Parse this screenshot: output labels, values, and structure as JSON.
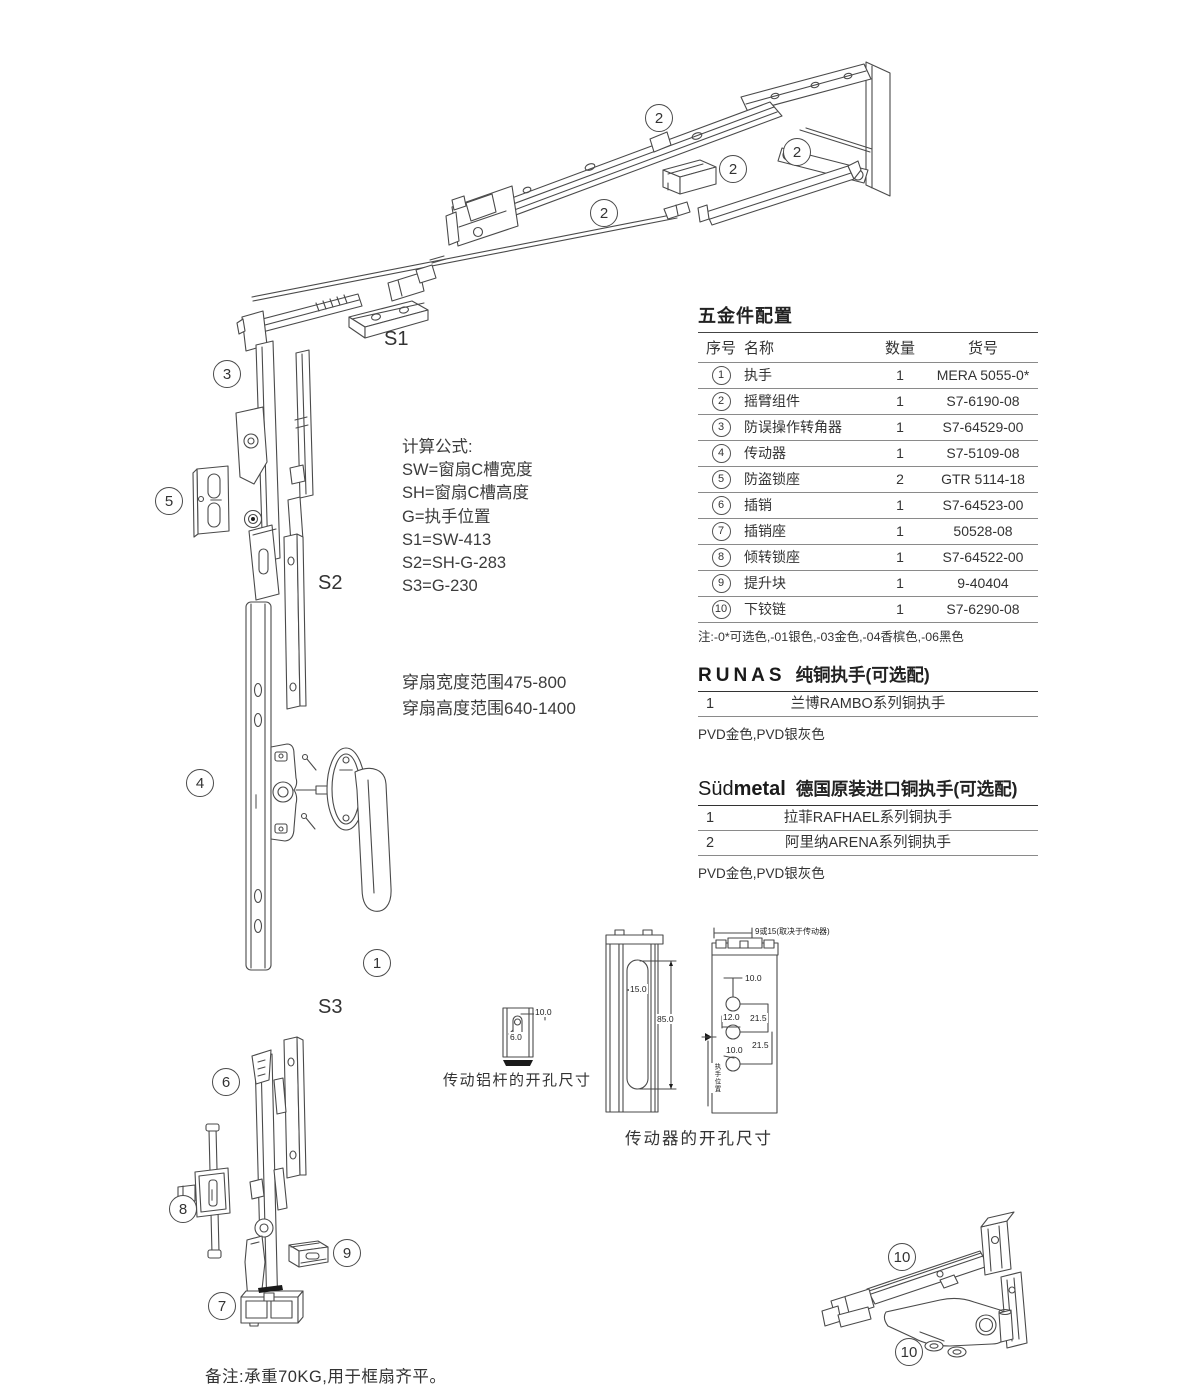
{
  "diagram": {
    "callouts": [
      "2",
      "2",
      "2",
      "2",
      "3",
      "5",
      "4",
      "1",
      "6",
      "8",
      "9",
      "7",
      "10",
      "10"
    ],
    "s_labels": {
      "s1": "S1",
      "s2": "S2",
      "s3": "S3"
    }
  },
  "formulas": {
    "heading": "计算公式:",
    "lines": [
      "SW=窗扇C槽宽度",
      "SH=窗扇C槽高度",
      "G=执手位置",
      "S1=SW-413",
      "S2=SH-G-283",
      "S3=G-230"
    ]
  },
  "sash_range": {
    "lines": [
      "穿扇宽度范围475-800",
      "穿扇高度范围640-1400"
    ]
  },
  "hardware_table": {
    "title": "五金件配置",
    "headers": {
      "no": "序号",
      "name": "名称",
      "qty": "数量",
      "sku": "货号"
    },
    "rows": [
      {
        "no": "1",
        "name": "执手",
        "qty": "1",
        "sku": "MERA 5055-0*"
      },
      {
        "no": "2",
        "name": "摇臂组件",
        "qty": "1",
        "sku": "S7-6190-08"
      },
      {
        "no": "3",
        "name": "防误操作转角器",
        "qty": "1",
        "sku": "S7-64529-00"
      },
      {
        "no": "4",
        "name": "传动器",
        "qty": "1",
        "sku": "S7-5109-08"
      },
      {
        "no": "5",
        "name": "防盗锁座",
        "qty": "2",
        "sku": "GTR 5114-18"
      },
      {
        "no": "6",
        "name": "插销",
        "qty": "1",
        "sku": "S7-64523-00"
      },
      {
        "no": "7",
        "name": "插销座",
        "qty": "1",
        "sku": "50528-08"
      },
      {
        "no": "8",
        "name": "倾转锁座",
        "qty": "1",
        "sku": "S7-64522-00"
      },
      {
        "no": "9",
        "name": "提升块",
        "qty": "1",
        "sku": "9-40404"
      },
      {
        "no": "10",
        "name": "下铰链",
        "qty": "1",
        "sku": "S7-6290-08"
      }
    ],
    "footnote": "注:-0*可选色,-01银色,-03金色,-04香槟色,-06黑色"
  },
  "runas_section": {
    "brand": "RUNAS",
    "title": "纯铜执手(可选配)",
    "rows": [
      {
        "no": "1",
        "name": "兰博RAMBO系列铜执手"
      }
    ],
    "finish_note": "PVD金色,PVD银灰色"
  },
  "sudmetal_section": {
    "brand_light": "Süd",
    "brand_bold": "metal",
    "title": "德国原装进口铜执手(可选配)",
    "rows": [
      {
        "no": "1",
        "name": "拉菲RAFHAEL系列铜执手"
      },
      {
        "no": "2",
        "name": "阿里纳ARENA系列铜执手"
      }
    ],
    "finish_note": "PVD金色,PVD银灰色"
  },
  "dim_drawings": {
    "rod": {
      "caption": "传动铝杆的开孔尺寸",
      "dims": [
        "10.0",
        "6.0"
      ]
    },
    "gear": {
      "caption": "传动器的开孔尺寸",
      "slot_width": "15.0",
      "slot_height": "85.0",
      "top_note": "9或15(取决于传动器)",
      "dims": [
        "10.0",
        "12.0",
        "21.5",
        "10.0",
        "21.5"
      ],
      "side_note": "执手位置"
    }
  },
  "bottom_note": "备注:承重70KG,用于框扇齐平。",
  "colors": {
    "line": "#4a4a4a",
    "text": "#333333"
  }
}
